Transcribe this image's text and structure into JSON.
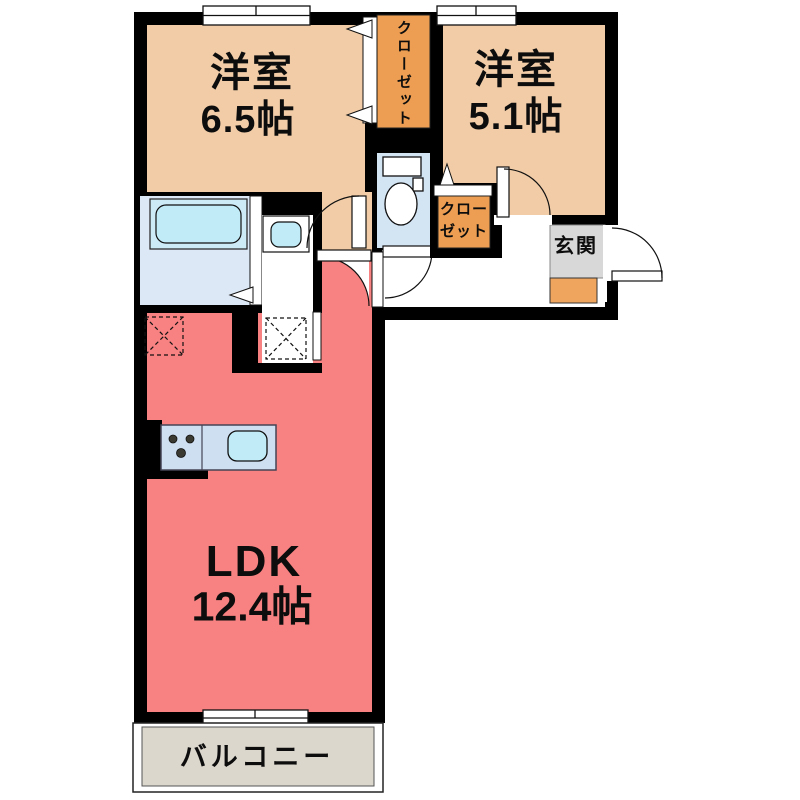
{
  "floor_plan": {
    "labels": {
      "room1_name": "洋室",
      "room1_size": "6.5帖",
      "room2_name": "洋室",
      "room2_size": "5.1帖",
      "ldk_name": "LDK",
      "ldk_size": "12.4帖",
      "closet1": "クローゼット",
      "closet2_line1": "クロー",
      "closet2_line2": "ゼット",
      "entrance": "玄関",
      "balcony": "バルコニー"
    },
    "colors": {
      "wall": "#000000",
      "western_room": "#f1cca7",
      "closet": "#ee9e52",
      "ldk": "#f88181",
      "bathroom": "#dce8f5",
      "tub_outer": "#cdeaf7",
      "water_fixture": "#c0ebf7",
      "toilet_room": "#d3e4f3",
      "kitchen_counter": "#cfdff2",
      "entrance_tile": "#d8d8d8",
      "entrance_step": "#f0a55f",
      "balcony_floor": "#dcd7cd",
      "hall": "#ffffff"
    },
    "fixture_icons": [
      "bathtub-icon",
      "washbasin-icon",
      "toilet-icon",
      "kitchen-sink-icon",
      "stove-icon",
      "washing-machine-space-icon",
      "refrigerator-space-icon"
    ]
  }
}
